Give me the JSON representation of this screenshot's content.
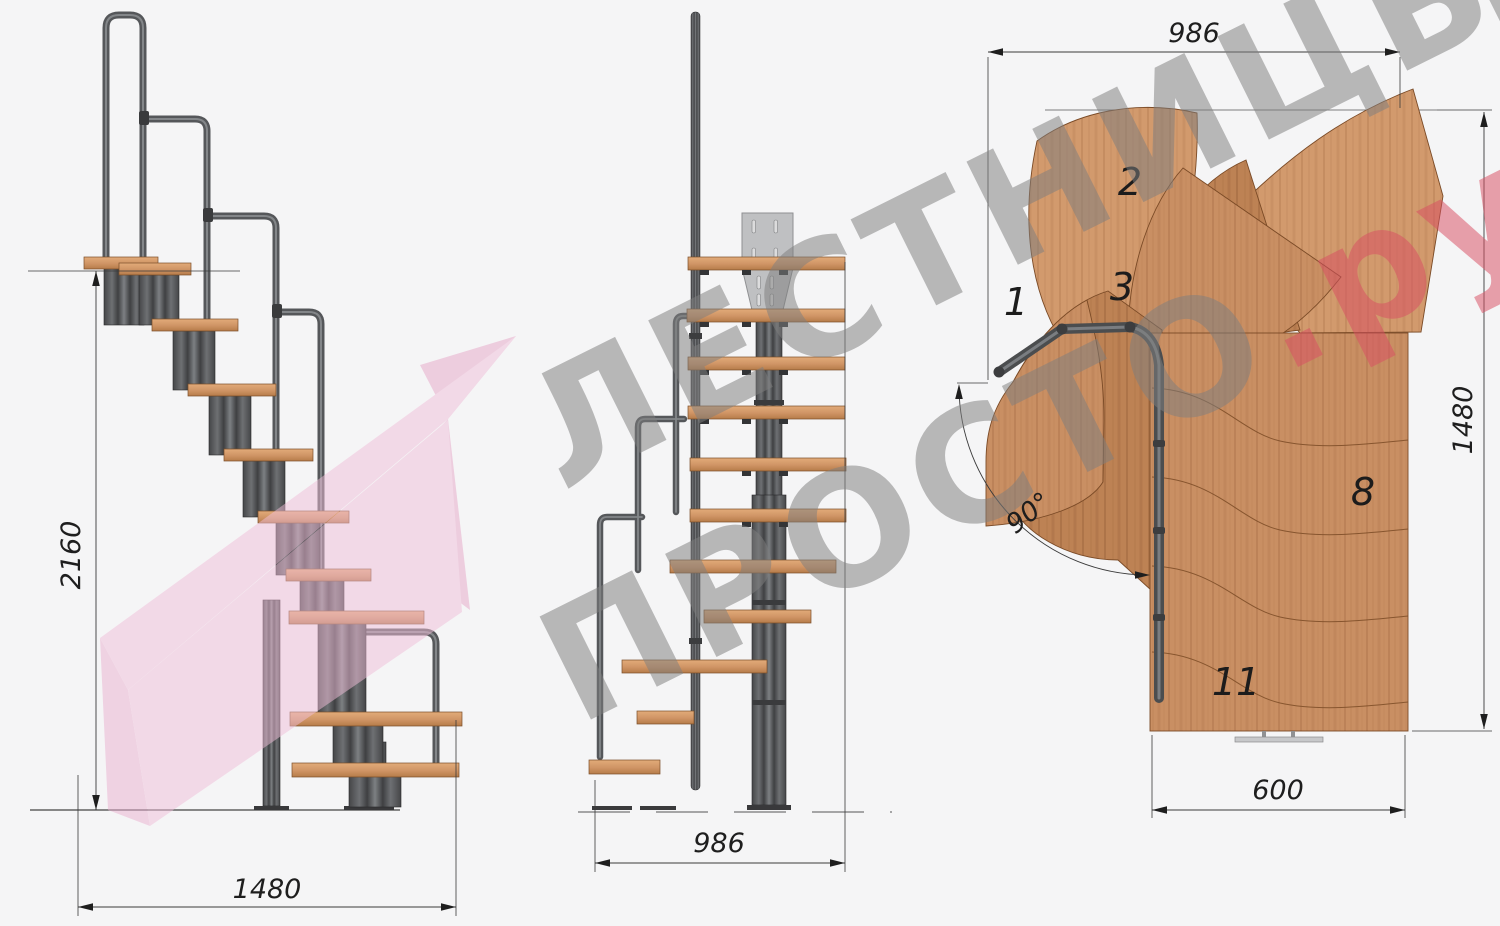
{
  "watermark": {
    "brand_line1": "ЛЕСТНИЦЫ",
    "brand_line2": "ПРОСТО",
    "brand_suffix": ".ру"
  },
  "side_view": {
    "height_mm": "2160",
    "width_mm": "1480"
  },
  "front_view": {
    "width_mm": "986"
  },
  "plan_view": {
    "width_mm": "986",
    "depth_mm": "1480",
    "exit_width_mm": "600",
    "turn_angle": "90°",
    "step_numbers": [
      "1",
      "2",
      "3",
      "8",
      "11"
    ]
  },
  "colors": {
    "background": "#f5f5f6",
    "wood": "#c98f63",
    "metal": "#4a4b4d",
    "rail": "#55575a",
    "dimension_line": "#3a3a3a",
    "watermark_gray": "#7f7f7f",
    "watermark_red": "#d94f63",
    "ribbon_pink": "#f1bfd9"
  }
}
